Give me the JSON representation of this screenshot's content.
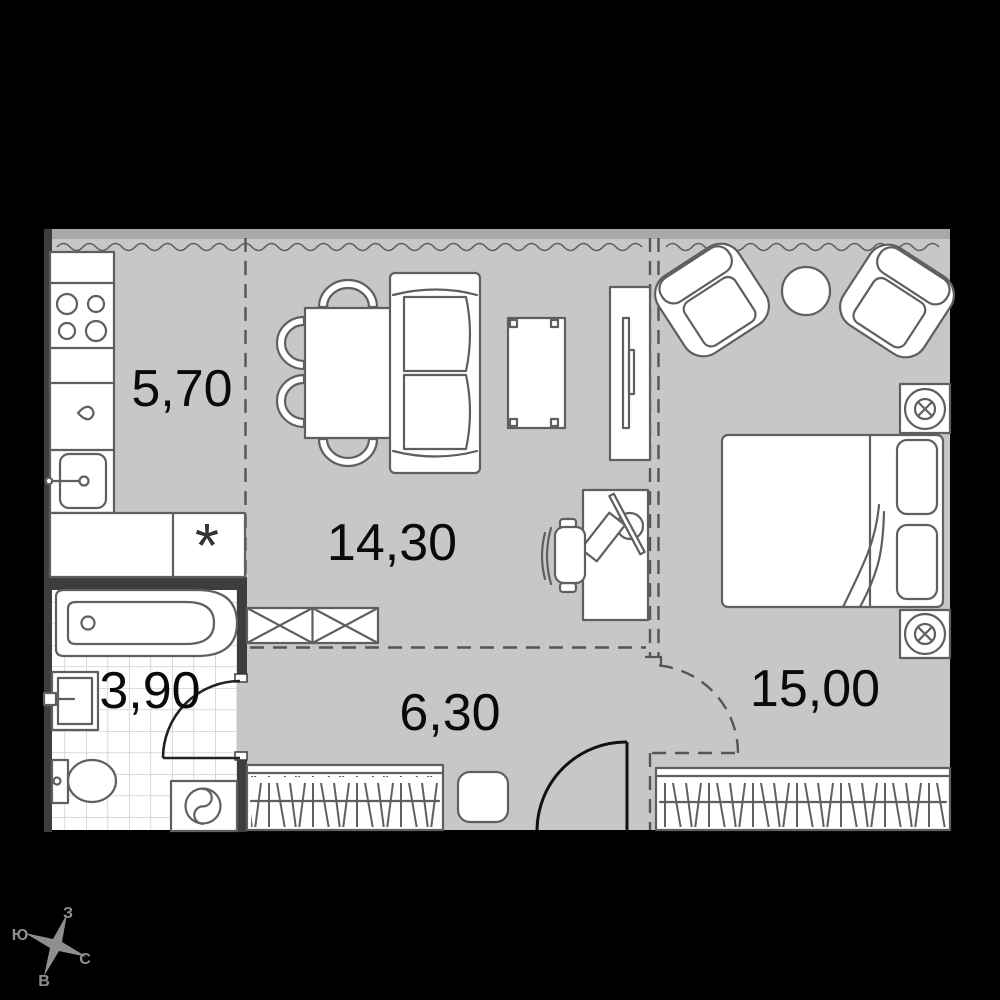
{
  "plan": {
    "title": "apartment-floor-plan",
    "rooms": [
      {
        "id": "kitchen",
        "area_label": "5,70"
      },
      {
        "id": "living-room",
        "area_label": "14,30"
      },
      {
        "id": "bathroom",
        "area_label": "3,90"
      },
      {
        "id": "hallway",
        "area_label": "6,30"
      },
      {
        "id": "bedroom",
        "area_label": "15,00"
      }
    ]
  },
  "symbols": {
    "appliance_asterisk": "*"
  },
  "compass": {
    "north": "С",
    "south": "Ю",
    "west": "З",
    "east": "В"
  },
  "colors": {
    "background": "#000000",
    "floor": "#c7c7c7",
    "furniture_fill": "#ffffff",
    "outline": "#5f5f5f",
    "wall_dark": "#3d3d3d",
    "tile_line": "#c6c6c6",
    "label_text": "#0a0a0a",
    "compass_gray": "#8f8f8f"
  }
}
